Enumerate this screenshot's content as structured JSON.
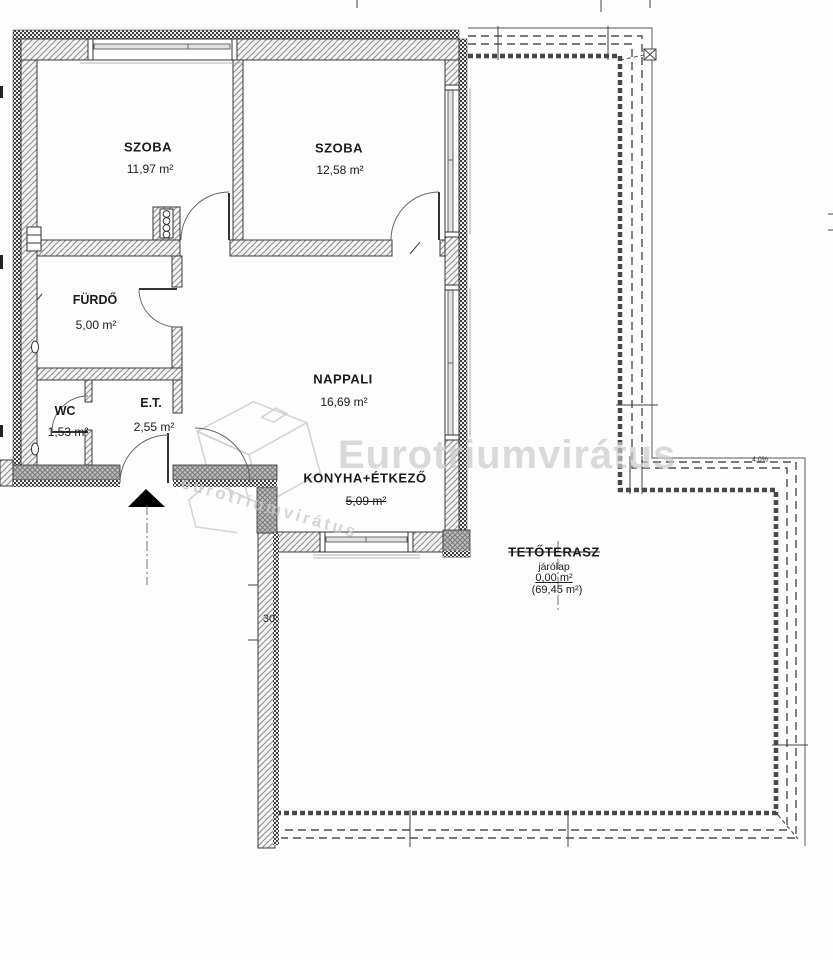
{
  "rooms": {
    "szoba1": {
      "name": "SZOBA",
      "area": "11,97 m²"
    },
    "szoba2": {
      "name": "SZOBA",
      "area": "12,58 m²"
    },
    "furdo": {
      "name": "FÜRDŐ",
      "area": "5,00 m²"
    },
    "wc": {
      "name": "WC",
      "area": "1,53 m²"
    },
    "eloter": {
      "name": "E.T.",
      "area": "2,55 m²"
    },
    "nappali": {
      "name": "NAPPALI",
      "area": "16,69 m²"
    },
    "konyha": {
      "name": "KONYHA+ÉTKEZŐ",
      "area": "5,09 m²"
    }
  },
  "terrace": {
    "name": "TETŐTERASZ",
    "finish": "járólap",
    "area": "0,00 m²",
    "gross_area": "(69,45 m²)",
    "slope_note": "4,0%"
  },
  "annotations": {
    "wall_dim": "30"
  },
  "watermark": {
    "text": "Eurotriumvirátus",
    "logo_text": "eurotriumvirátus"
  },
  "colors": {
    "line": "#3a3a3a",
    "wall_hatch": "#8f8f8f",
    "insulation": "#3f3f3f",
    "dark_band": "#bdbdbd",
    "watermark": "#cbcbcb"
  }
}
